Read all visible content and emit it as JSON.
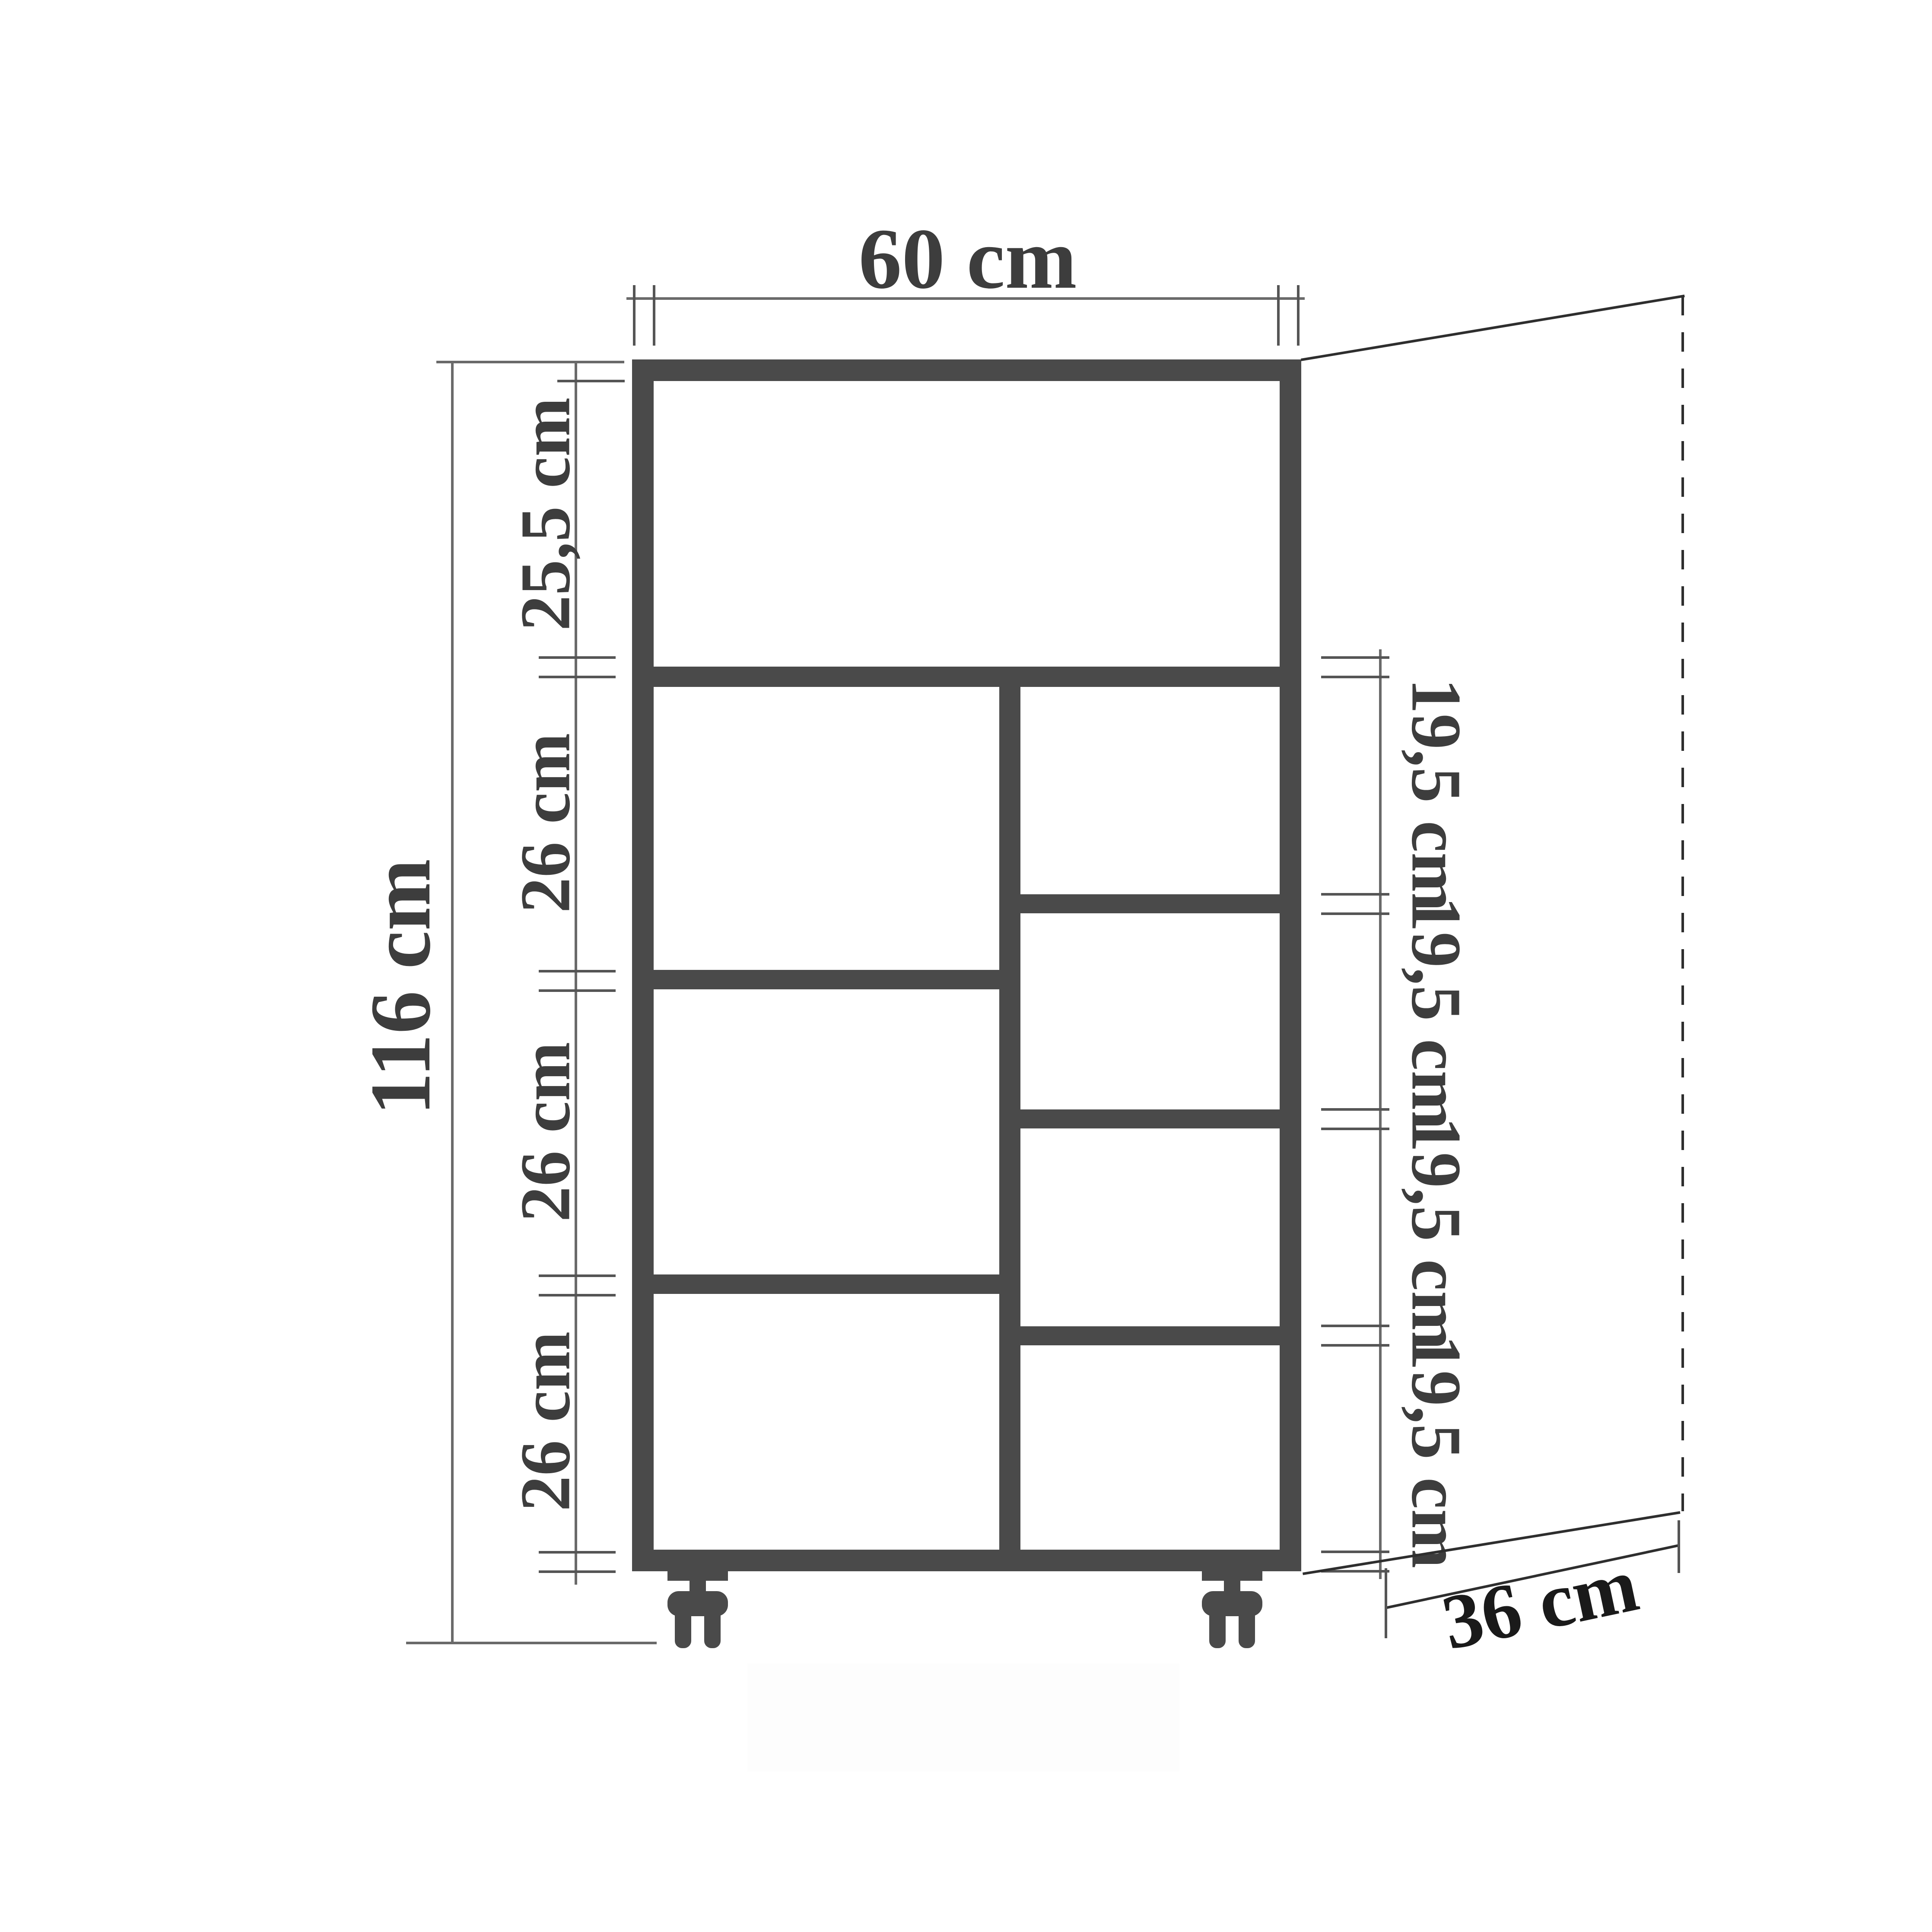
{
  "diagram": {
    "type": "furniture-dimension-drawing",
    "subject": "shelf cabinet on caster wheels, front view with depth perspective",
    "unit": "cm",
    "labels": {
      "width_top": "60 cm",
      "height_left": "116 cm",
      "depth_bottom": "36 cm",
      "top_compartment": "25,5 cm",
      "left_shelves": [
        "26 cm",
        "26 cm",
        "26 cm"
      ],
      "right_shelves": [
        "19,5 cm",
        "19,5 cm",
        "19,5 cm",
        "19,5 cm"
      ]
    },
    "colors": {
      "background": "#ffffff",
      "cabinet": "#4a4a4a",
      "dimension_line": "#6a6a6a",
      "tick_mark": "#555555",
      "perspective_line": "#2e2e2e",
      "label_text": "#3d3d3d",
      "depth_label_text": "#1a1a1a"
    }
  }
}
